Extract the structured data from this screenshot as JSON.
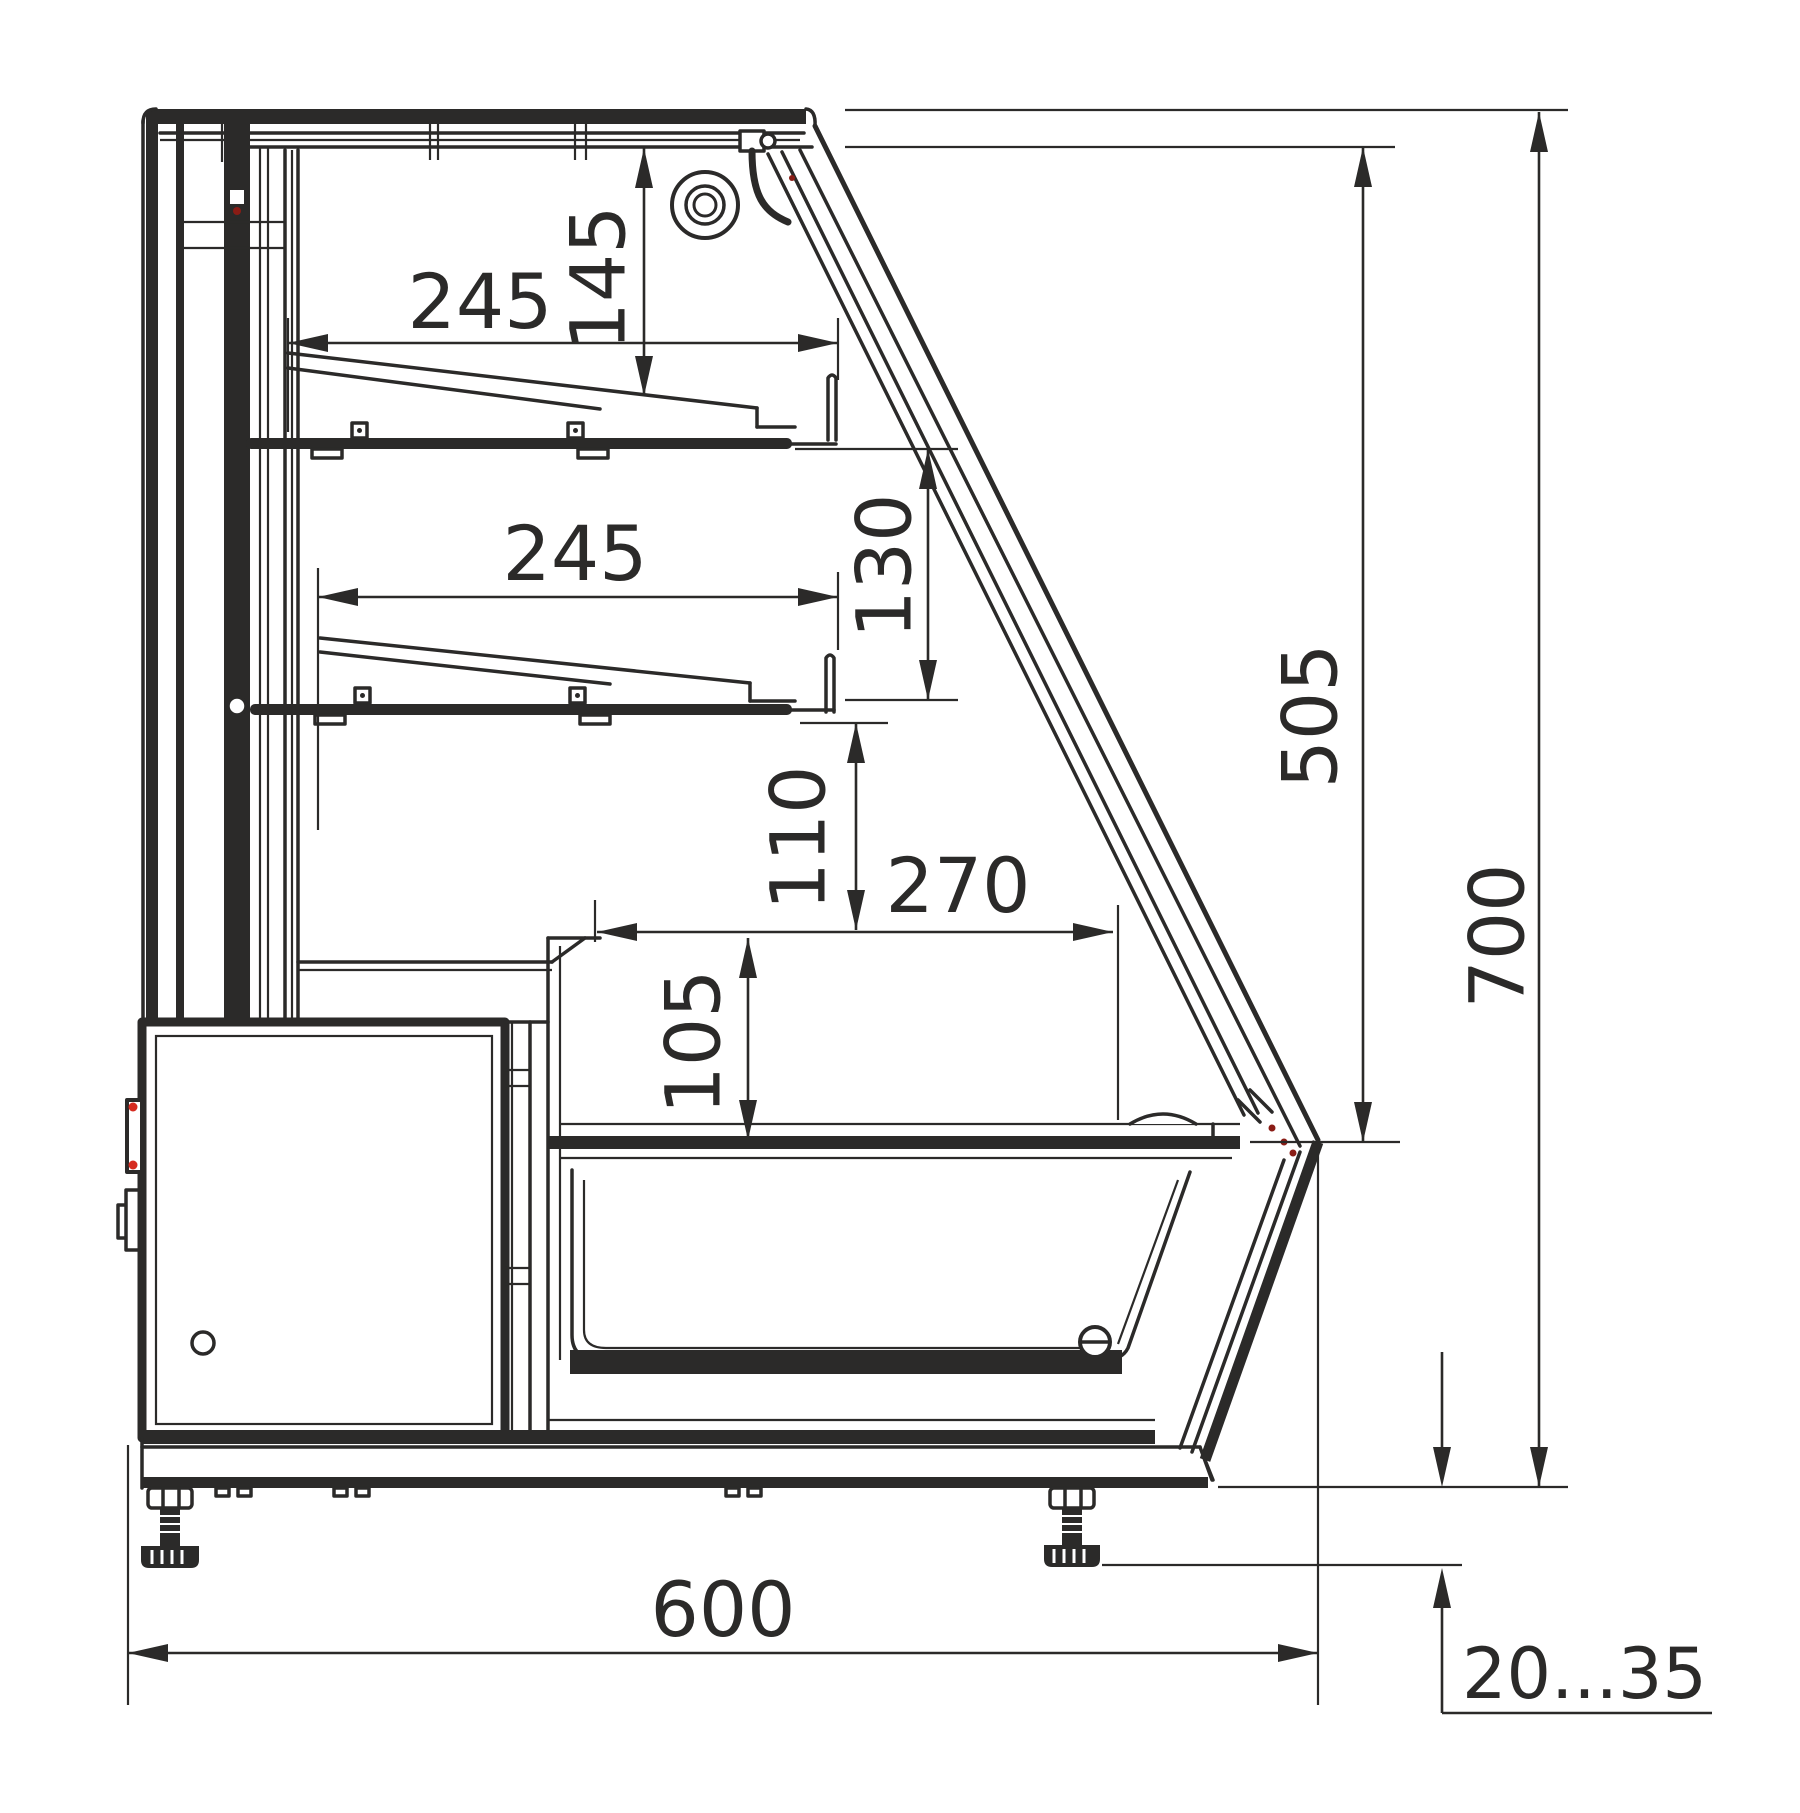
{
  "drawing": {
    "kind": "refrigerated display case side cross-section",
    "style": "black line CAD drawing on white"
  },
  "colors": {
    "line": "#2b2a29",
    "bg": "#ffffff",
    "accent-red": "#d62b20",
    "dark-red": "#8a1c15"
  },
  "dimensions": {
    "shelf_upper_depth": "245",
    "shelf_upper_clearance": "145",
    "shelf_lower_depth": "245",
    "shelf_lower_clearance": "130",
    "well_top_clearance": "110",
    "well_opening_depth": "270",
    "well_depth": "105",
    "glass_front_height": "505",
    "overall_height": "700",
    "overall_depth": "600",
    "leg_adjustment_range": "20...35"
  }
}
